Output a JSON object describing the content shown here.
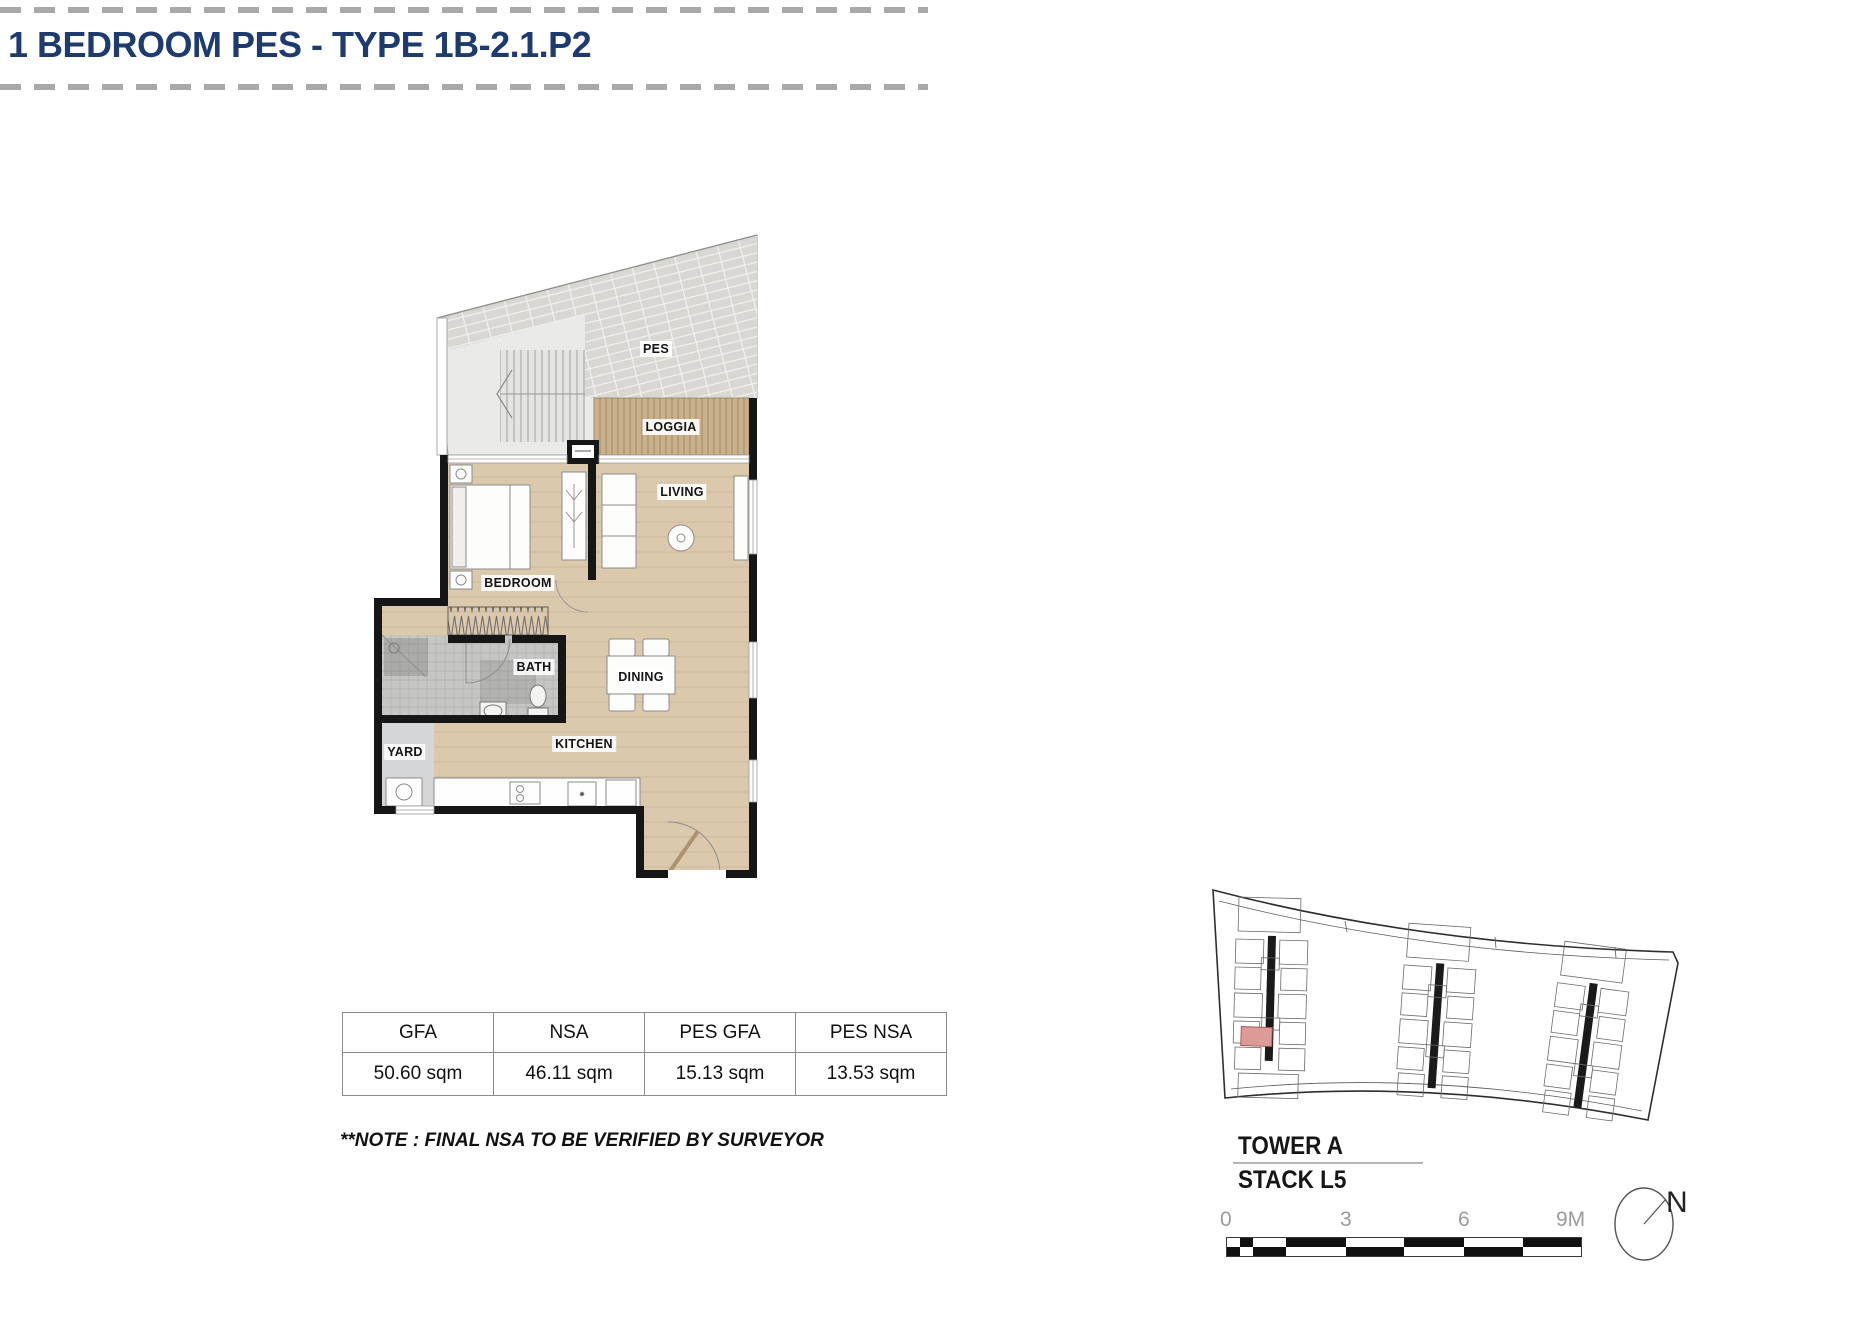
{
  "header": {
    "title": "1 BEDROOM PES - TYPE 1B-2.1.P2"
  },
  "floor_plan": {
    "rooms": [
      {
        "id": "pes",
        "label": "PES"
      },
      {
        "id": "loggia",
        "label": "LOGGIA"
      },
      {
        "id": "living",
        "label": "LIVING"
      },
      {
        "id": "bedroom",
        "label": "BEDROOM"
      },
      {
        "id": "bath",
        "label": "BATH"
      },
      {
        "id": "dining",
        "label": "DINING"
      },
      {
        "id": "yard",
        "label": "YARD"
      },
      {
        "id": "kitchen",
        "label": "KITCHEN"
      }
    ]
  },
  "area_table": {
    "columns": [
      "GFA",
      "NSA",
      "PES GFA",
      "PES NSA"
    ],
    "values": [
      "50.60 sqm",
      "46.11 sqm",
      "15.13 sqm",
      "13.53 sqm"
    ]
  },
  "note": "**NOTE : FINAL NSA TO BE VERIFIED BY SURVEYOR",
  "site_plan": {
    "tower": "TOWER A",
    "stack": "STACK L5",
    "north_label": "N",
    "scale_ticks": [
      "0",
      "3",
      "6",
      "9M"
    ],
    "highlight_color": "#dd9b98"
  },
  "colors": {
    "title": "#1d3b6f",
    "dashed_rule": "#a9a9a9",
    "wall": "#161616",
    "floor_wood": "#dbc9ad",
    "loggia_wood": "#c9b18c",
    "bath_tile": "#c6c6c4",
    "pes_paving": "#d8d7d4",
    "unit_highlight": "#dd9b98"
  }
}
